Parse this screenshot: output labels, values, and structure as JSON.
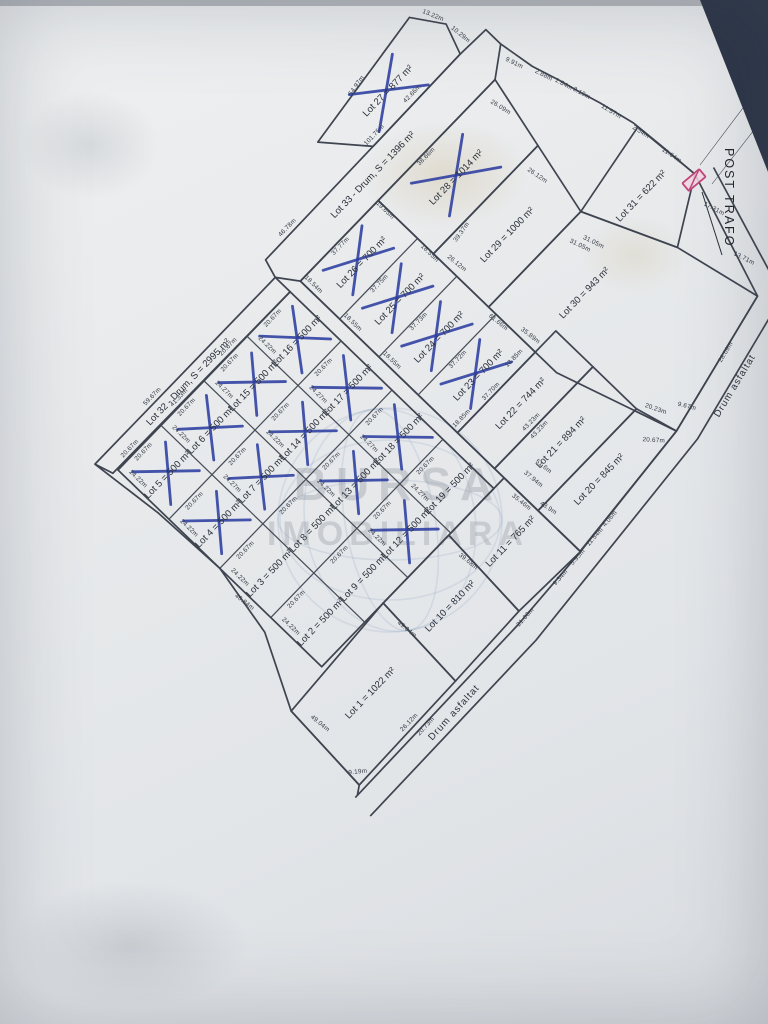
{
  "watermark": {
    "line1": "BURSA",
    "line2": "IMOBILIARA"
  },
  "post_trafo": "POST TRAFO",
  "roads": {
    "lot32": "Lot 32 - Drum, S = 2995 m²",
    "lot33": "Lot 33 - Drum, S = 1396 m²",
    "asphalt_right": "Drum asfaltat",
    "asphalt_bottom": "Drum asfaltat"
  },
  "lots": {
    "l1": "Lot 1 = 1022 m²",
    "l2": "Lot 2 = 500 m²",
    "l3": "Lot 3 = 500 m²",
    "l4": "Lot 4 = 500 m²",
    "l5": "Lot 5 = 500 m²",
    "l6": "Lot 6 = 500 m²",
    "l7": "Lot 7 = 500 m²",
    "l8": "Lot 8 = 500 m²",
    "l9": "Lot 9 = 500 m²",
    "l10": "Lot 10 = 810 m²",
    "l11": "Lot 11 = 765 m²",
    "l12": "Lot 12 = 500 m²",
    "l13": "Lot 13 = 500 m²",
    "l14": "Lot 14 = 500 m²",
    "l15": "Lot 15 = 500 m²",
    "l16": "Lot 16 = 500 m²",
    "l17": "Lot 17 = 500 m²",
    "l18": "Lot 18 = 500 m²",
    "l19": "Lot 19 = 500 m²",
    "l20": "Lot 20 = 845 m²",
    "l21": "Lot 21 = 894 m²",
    "l22": "Lot 22 = 744 m²",
    "l23": "Lot 23 = 700 m²",
    "l24": "Lot 24 = 700 m²",
    "l25": "Lot 25 = 700 m²",
    "l26": "Lot 26 = 700 m²",
    "l27": "Lot 27 = 877 m²",
    "l28": "Lot 28 = 1014 m²",
    "l29": "Lot 29 = 1000 m²",
    "l30": "Lot 30 = 943 m²",
    "l31": "Lot 31 = 622 m²"
  },
  "crossed_out_lots": [
    4,
    5,
    6,
    7,
    12,
    13,
    14,
    15,
    16,
    17,
    18,
    23,
    24,
    25,
    26,
    27,
    28
  ],
  "dims": {
    "cell_w": "20.67m",
    "cell_h": "24.22m",
    "cell_h2": "24.27m",
    "d5967": "59.67m",
    "d4133": "41.33m",
    "d4684": "46.84m",
    "d4904": "49.04m",
    "d3968": "39.68m",
    "d3546": "35.46m",
    "d439": "43.9m",
    "d2612": "26.12m",
    "d919": "9.19m",
    "d2073": "20.73m",
    "d2106": "21.06m",
    "d934": "9.34m",
    "d595": "5.95m",
    "d1154": "11.54m",
    "d406": "4.06m",
    "d2023": "20.23m",
    "d2067r": "20.67m",
    "d967": "9.67m",
    "d2809": "28.09m",
    "d1371": "13.71m",
    "d1731": "17.31m",
    "d254": "2.54m",
    "d1164": "11.64m",
    "d1157": "11.57m",
    "d219": "2.19m",
    "d184": "1.84m",
    "d288": "2.88m",
    "d991": "9.91m",
    "d10175": "101.75m",
    "d4678": "46.78m",
    "d5497": "54.97m",
    "d1322": "13.22m",
    "d1029": "10.29m",
    "d4266": "42.66m",
    "d3866": "38.66m",
    "d2609": "26.09m",
    "d3937": "39.37m",
    "d2612b": "26.12m",
    "d3105": "31.05m",
    "d3589": "35.89m",
    "d6166": "61.66m",
    "d3777": "37.77m",
    "d3775": "37.75m",
    "d3773": "37.73m",
    "d3772": "37.72m",
    "d3770": "37.70m",
    "d1885": "18.85m",
    "d1854": "18.54m",
    "d1855": "18.55m",
    "d1965": "19.65m",
    "d4323": "43.23m",
    "d3794": "37.94m",
    "d516": "51.6m"
  }
}
